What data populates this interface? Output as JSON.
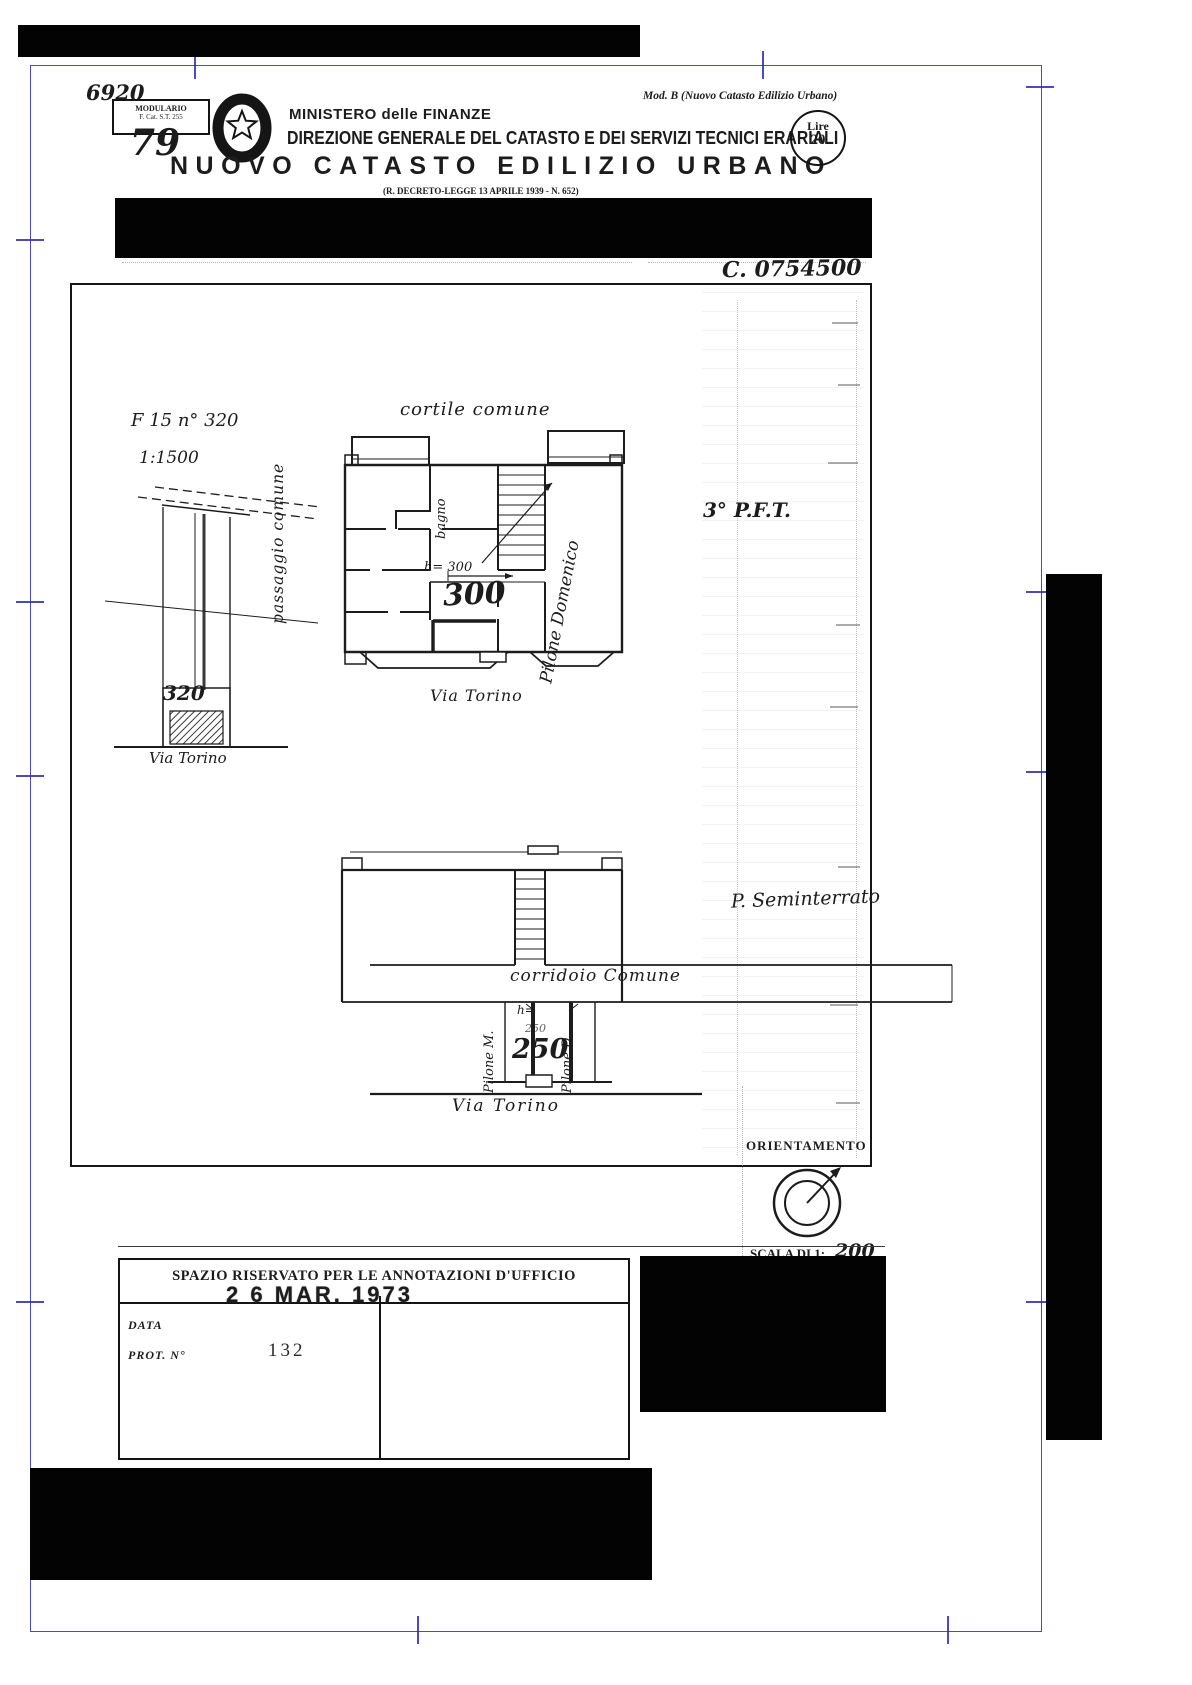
{
  "colors": {
    "registration_blue": "#2b2bb0",
    "ink": "#1c1c1c",
    "paper": "#ffffff"
  },
  "header": {
    "handwritten_number": "6920",
    "modulario_line1": "MODULARIO",
    "modulario_line2": "F.  Cat. S.T.  255",
    "sheet_number": "79",
    "form_label": "Mod. B (Nuovo Catasto Edilizio Urbano)",
    "ministry": "MINISTERO delle FINANZE",
    "direction": "DIREZIONE GENERALE DEL CATASTO E DEI SERVIZI TECNICI ERARIALI",
    "title": "NUOVO CATASTO EDILIZIO URBANO",
    "subtitle": "(R. DECRETO-LEGGE 13 APRILE 1939 - N. 652)",
    "stamp_currency": "Lire",
    "stamp_value": "20",
    "protocol_code": "C. 0754500"
  },
  "drawing": {
    "map_sheet": "F 15   n° 320",
    "map_scale": "1:1500",
    "parcel_number": "320",
    "street_small_plan": "Via Torino",
    "passage_label": "passaggio comune",
    "courtyard_label": "cortile comune",
    "bath_label": "bagno",
    "upper_height_note": "h= 300",
    "upper_height_value": "300",
    "owner_name": "Pilone Domenico",
    "upper_floor_label": "3° P.F.T.",
    "street_upper_plan": "Via Torino",
    "lower_floor_label": "P. Seminterrato",
    "corridor_label": "corridoio Comune",
    "cell_left_owner": "Pilone M.",
    "lower_height_prefix": "h=",
    "lower_height_small": "250",
    "lower_height_value": "250",
    "cell_right_owner": "Pilone D.",
    "street_lower_plan": "Via Torino",
    "orientation_label": "ORIENTAMENTO",
    "scale_caption": "SCALA DI 1:",
    "scale_value": "200"
  },
  "office_box": {
    "header": "SPAZIO RISERVATO PER LE ANNOTAZIONI D'UFFICIO",
    "date_stamp": "2 6 MAR. 1973",
    "date_label": "DATA",
    "protocol_label": "PROT. N°",
    "protocol_number": "132"
  }
}
